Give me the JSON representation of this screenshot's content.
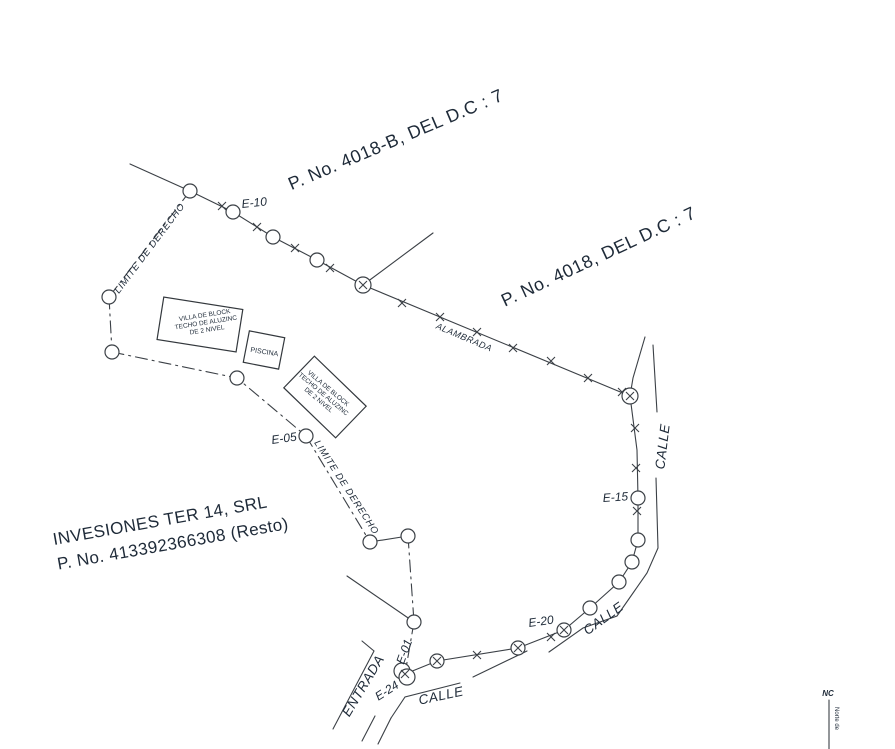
{
  "parcels": {
    "p4018b": "P. No. 4018-B, DEL D.C : 7",
    "p4018": "P. No. 4018, DEL D.C : 7",
    "owner1": "INVESIONES TER 14, SRL",
    "owner2": "P. No. 413392366308 (Resto)"
  },
  "stations": {
    "e10": "E-10",
    "e05": "E-05",
    "e15": "E-15",
    "e20": "E-20",
    "e01": "E-01",
    "e24": "E-24"
  },
  "lines": {
    "alambrada": "ALAMBRADA",
    "limite_izq": "LIMITE DE DERECHO",
    "limite_der": "LIMITE DE DERECHO"
  },
  "streets": {
    "entrada": "ENTRADA",
    "calle_sur": "CALLE",
    "calle_curva": "CALLE",
    "calle_este": "CALLE"
  },
  "buildings": {
    "villa_a_1": "VILLA DE BLOCK",
    "villa_a_2": "TECHO DE ALUZINC",
    "villa_a_3": "DE 2 NIVEL",
    "piscina": "PISCINA",
    "villa_b_1": "VILLA DE BLOCK",
    "villa_b_2": "TECHO DE ALUZINC",
    "villa_b_3": "DE 2 NIVEL"
  },
  "margin": {
    "nc": "NC",
    "note": "Norte de"
  },
  "colors": {
    "ink": "#1e2a38",
    "line": "#3b4046",
    "paper": "#ffffff"
  }
}
